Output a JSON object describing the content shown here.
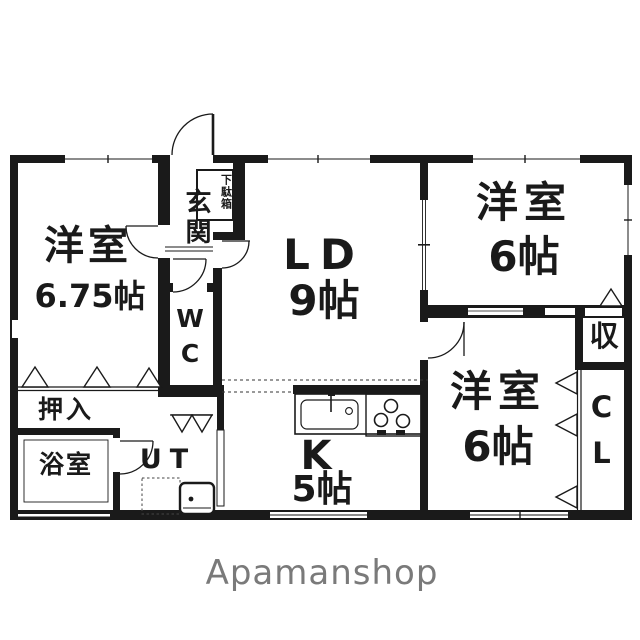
{
  "floorplan": {
    "rooms": {
      "west_room_1": {
        "label": "洋室",
        "size": "6.75帖"
      },
      "living_dining": {
        "label": "LD",
        "size": "9帖"
      },
      "west_room_2": {
        "label": "洋室",
        "size": "6帖"
      },
      "west_room_3": {
        "label": "洋室",
        "size": "6帖"
      },
      "kitchen": {
        "label": "K",
        "size": "5帖"
      },
      "entrance": {
        "label": "玄関"
      },
      "shoe_cabinet": {
        "label": "下駄箱"
      },
      "wc": {
        "label": "WC"
      },
      "oshiire": {
        "label": "押入"
      },
      "bathroom": {
        "label": "浴室"
      },
      "utility": {
        "label": "UT"
      },
      "storage": {
        "label": "収"
      },
      "closet": {
        "label": "CL"
      }
    },
    "branding": {
      "logo_text": "Apamanshop"
    },
    "colors": {
      "wall": "#1a1a1a",
      "background": "#ffffff",
      "logo": "#7a7a7a"
    }
  }
}
